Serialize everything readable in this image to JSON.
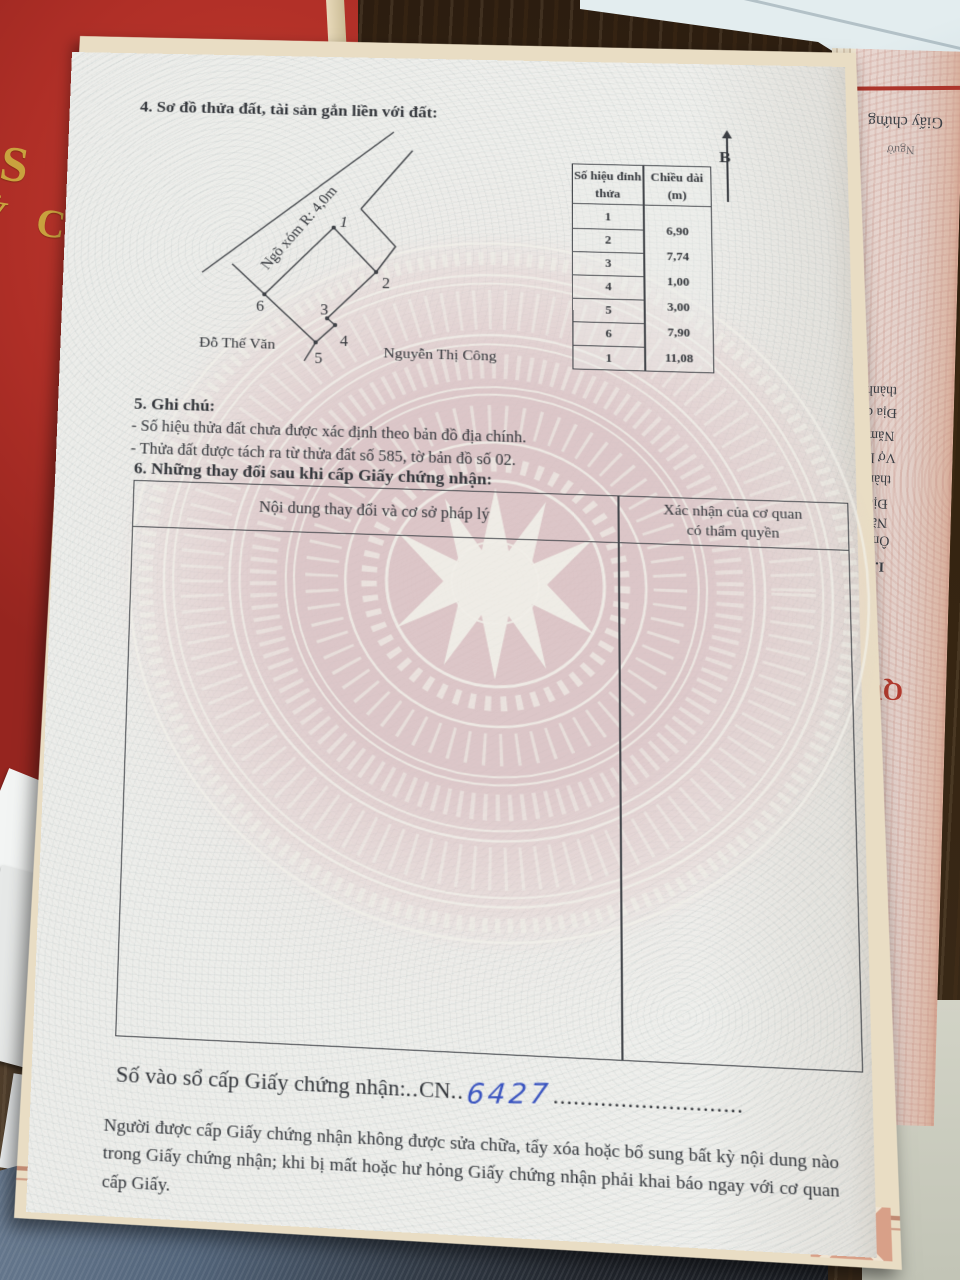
{
  "page": {
    "section4": {
      "heading": "4. Sơ đồ thửa đất, tài sản gắn liền với đất:"
    },
    "diagram": {
      "road_label": "Ngõ xóm R: 4,0m",
      "owner_left": "Đỗ Thế Văn",
      "owner_bottom": "Nguyễn Thị Công",
      "vertex_labels": [
        "1",
        "2",
        "3",
        "4",
        "5",
        "6"
      ],
      "north_label": "B"
    },
    "measure_table": {
      "col1_header_line1": "Số hiệu đỉnh",
      "col1_header_line2": "thửa",
      "col2_header_line1": "Chiều dài",
      "col2_header_line2": "(m)",
      "vertex_rows": [
        "1",
        "2",
        "3",
        "4",
        "5",
        "6",
        "1"
      ],
      "lengths": [
        "6,90",
        "7,74",
        "1,00",
        "3,00",
        "7,90",
        "11,08"
      ]
    },
    "section5": {
      "heading": "5. Ghi chú:",
      "note1": "- Số hiệu thửa đất chưa được xác định theo bản đồ địa chính.",
      "note2": "- Thửa đất được tách ra từ thửa đất số 585, tờ bản đồ số 02."
    },
    "section6": {
      "heading": "6. Những thay đổi sau khi cấp Giấy chứng nhận:",
      "col1_header": "Nội dung thay đổi và cơ sở pháp lý",
      "col2_header_line1": "Xác nhận của cơ quan",
      "col2_header_line2": "có thẩm quyền"
    },
    "registry": {
      "label": "Số vào sổ cấp Giấy chứng nhận:",
      "dots_a": "..",
      "prefix": "CN",
      "dots_b": "..",
      "number": "6427",
      "dots_c": "............................"
    },
    "footer_text": "Người được cấp Giấy chứng nhận không được sửa chữa, tẩy xóa hoặc bổ sung bất kỳ nội dung nào trong Giấy chứng nhận; khi bị mất hoặc hư hỏng Giấy chứng nhận phải khai báo ngay với cơ quan cấp Giấy."
  },
  "surroundings": {
    "red_book_fragment1": "S N",
    "red_book_fragment2": "Ỷ C",
    "right_page_fragments": {
      "f0": "Giấy chứng",
      "f1": "Ngườ",
      "f2": "thành l",
      "f3": "Địa ch",
      "f4": "Năm",
      "f5": "Vợ là",
      "f6": "thành",
      "f7": "Địa",
      "f8": "Nă",
      "f9": "Ôn",
      "f10": "I. N",
      "f11": "QU"
    }
  },
  "colors": {
    "page_base": "#ecedea",
    "watermark_pink": "#dcc0c2",
    "red_cover": "#b02f27",
    "gold": "#c9a23e",
    "ink": "#33363b",
    "handwriting_blue": "#3b55c0",
    "wood": "#34230f",
    "denim": "#52647a"
  }
}
